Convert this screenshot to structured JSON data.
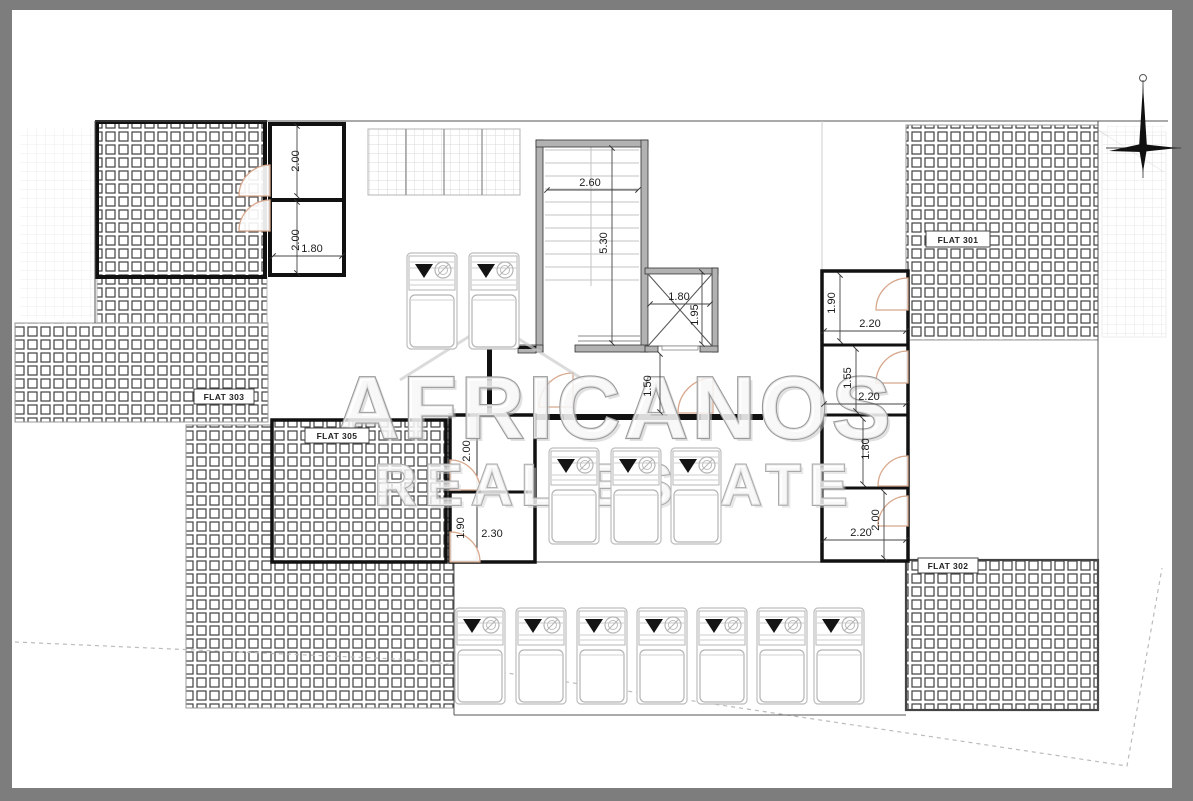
{
  "drawing": {
    "flats": {
      "f301": "FLAT 301",
      "f302": "FLAT 302",
      "f303": "FLAT 303",
      "f305": "FLAT 305"
    },
    "dims": {
      "tl_room1_h": "2.00",
      "tl_room2_h": "2.00",
      "tl_room2_w": "1.80",
      "stair_width": "2.60",
      "stair_depth": "5.30",
      "lift_width": "1.80",
      "lift_depth": "1.95",
      "corridor_width": "1.50",
      "r301_1_h": "1.90",
      "r301_1_w": "2.20",
      "r301_2_h": "1.55",
      "r301_2_w": "2.20",
      "r301_3_h": "1.80",
      "r301_4_h": "2.00",
      "r301_4_w": "2.20",
      "lm_room1_h": "2.00",
      "lm_room2_h": "1.90",
      "lm_room2_w": "2.30"
    },
    "watermark": {
      "line1": "AFRICANOS",
      "line2": "REAL ESTATE"
    },
    "colors": {
      "frame": "#7d7d7d",
      "wall_fill": "#b2b2b2",
      "door_arc": "#d8a88d",
      "hatch_line": "#3f3f3f"
    }
  }
}
